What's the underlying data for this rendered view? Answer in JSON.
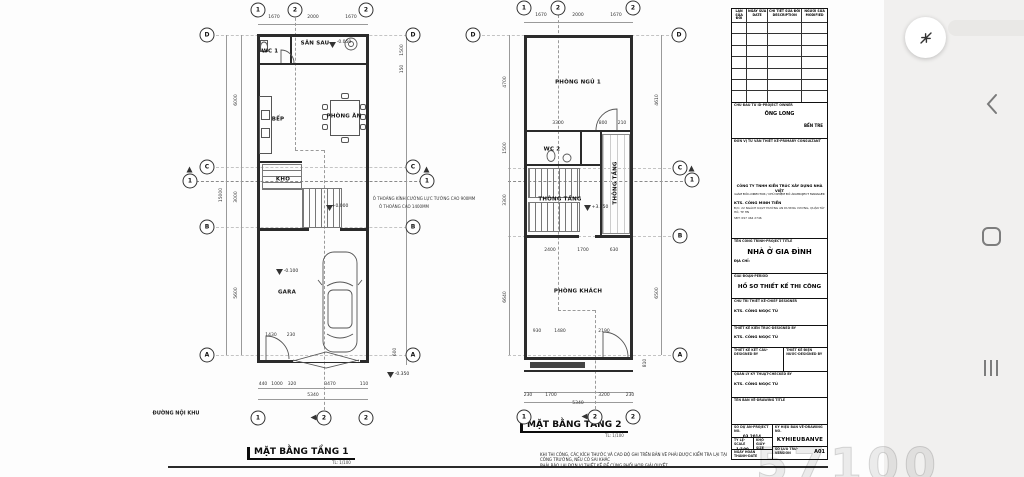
{
  "viewer": {
    "watermark": "57100",
    "icons": {
      "fab": "collapse-arrows-icon",
      "back": "back-chevron-icon",
      "home": "home-icon",
      "recents": "recents-icon"
    }
  },
  "plan1": {
    "title": "MẶT BẰNG TẦNG 1",
    "scale_note": "TL: 1/100",
    "labels": [
      {
        "t": "1670",
        "x": 274,
        "y": 18,
        "k": "dim"
      },
      {
        "t": "2000",
        "x": 313,
        "y": 18,
        "k": "dim"
      },
      {
        "t": "1670",
        "x": 351,
        "y": 18,
        "k": "dim"
      },
      {
        "t": "15000",
        "x": 222,
        "y": 195,
        "k": "dim",
        "r": 1
      },
      {
        "t": "6000",
        "x": 237,
        "y": 100,
        "k": "dim",
        "r": 1
      },
      {
        "t": "3000",
        "x": 237,
        "y": 197,
        "k": "dim",
        "r": 1
      },
      {
        "t": "5600",
        "x": 237,
        "y": 293,
        "k": "dim",
        "r": 1
      },
      {
        "t": "1500",
        "x": 403,
        "y": 50,
        "k": "dim",
        "r": 1
      },
      {
        "t": "150",
        "x": 403,
        "y": 69,
        "k": "dim",
        "r": 1
      },
      {
        "t": "600",
        "x": 396,
        "y": 352,
        "k": "dim",
        "r": 1
      },
      {
        "t": "1430",
        "x": 271,
        "y": 336,
        "k": "dim"
      },
      {
        "t": "230",
        "x": 291,
        "y": 336,
        "k": "dim"
      },
      {
        "t": "440",
        "x": 263,
        "y": 385,
        "k": "dim"
      },
      {
        "t": "1000",
        "x": 277,
        "y": 385,
        "k": "dim"
      },
      {
        "t": "320",
        "x": 292,
        "y": 385,
        "k": "dim"
      },
      {
        "t": "3470",
        "x": 330,
        "y": 385,
        "k": "dim"
      },
      {
        "t": "110",
        "x": 364,
        "y": 385,
        "k": "dim"
      },
      {
        "t": "5340",
        "x": 313,
        "y": 396,
        "k": "dim"
      },
      {
        "t": "-0.050",
        "x": 344,
        "y": 43,
        "k": "lvl"
      },
      {
        "t": "+0.000",
        "x": 340,
        "y": 207,
        "k": "lvl"
      },
      {
        "t": "-0.100",
        "x": 291,
        "y": 272,
        "k": "lvl"
      },
      {
        "t": "-0.350",
        "x": 402,
        "y": 375,
        "k": "lvl"
      },
      {
        "t": "WC 1",
        "x": 270,
        "y": 52,
        "k": "room"
      },
      {
        "t": "SÂN SAU",
        "x": 315,
        "y": 44,
        "k": "room"
      },
      {
        "t": "PHÒNG ĂN",
        "x": 344,
        "y": 117,
        "k": "room"
      },
      {
        "t": "BẾP",
        "x": 278,
        "y": 120,
        "k": "room"
      },
      {
        "t": "KHO",
        "x": 283,
        "y": 180,
        "k": "room"
      },
      {
        "t": "GARA",
        "x": 287,
        "y": 293,
        "k": "room"
      },
      {
        "t": "Ô THOÁNG KÍNH CƯỜNG LỰC TƯỜNG CAO 900MM",
        "x": 424,
        "y": 199,
        "k": "note"
      },
      {
        "t": "Ô THOÁNG CAO 1400MM",
        "x": 404,
        "y": 207,
        "k": "note"
      },
      {
        "t": "ĐƯỜNG NỘI KHU",
        "x": 176,
        "y": 414,
        "k": "street"
      }
    ],
    "bubbles": [
      {
        "l": "1",
        "x": 258,
        "y": 10
      },
      {
        "l": "2",
        "x": 295,
        "y": 10
      },
      {
        "l": "2",
        "x": 366,
        "y": 10
      },
      {
        "l": "D",
        "x": 207,
        "y": 35
      },
      {
        "l": "C",
        "x": 207,
        "y": 167
      },
      {
        "l": "B",
        "x": 207,
        "y": 227
      },
      {
        "l": "A",
        "x": 207,
        "y": 355
      },
      {
        "l": "D",
        "x": 413,
        "y": 35
      },
      {
        "l": "C",
        "x": 413,
        "y": 167
      },
      {
        "l": "B",
        "x": 413,
        "y": 227
      },
      {
        "l": "A",
        "x": 413,
        "y": 355
      },
      {
        "l": "1",
        "x": 258,
        "y": 418
      },
      {
        "l": "2",
        "x": 324,
        "y": 418,
        "a": "l"
      },
      {
        "l": "2",
        "x": 366,
        "y": 418
      },
      {
        "l": "1",
        "x": 190,
        "y": 181,
        "a": "u"
      },
      {
        "l": "1",
        "x": 427,
        "y": 181,
        "a": "u"
      }
    ]
  },
  "plan2": {
    "title": "MẶT BẰNG TẦNG 2",
    "scale_note": "TL: 1/100",
    "notes": [
      "KHI THI CÔNG, CÁC KÍCH THƯỚC VÀ CAO ĐỘ GHI TRÊN BẢN VẼ PHẢI ĐƯỢC KIỂM TRA LẠI TẠI CÔNG TRƯỜNG, NẾU CÓ SAI KHÁC",
      "PHẢI BÁO LẠI ĐƠN VỊ THIẾT KẾ ĐỂ CÙNG PHỐI HỢP GIẢI QUYẾT."
    ],
    "labels": [
      {
        "t": "1670",
        "x": 541,
        "y": 16,
        "k": "dim"
      },
      {
        "t": "2000",
        "x": 578,
        "y": 16,
        "k": "dim"
      },
      {
        "t": "1670",
        "x": 616,
        "y": 16,
        "k": "dim"
      },
      {
        "t": "4700",
        "x": 506,
        "y": 82,
        "k": "dim",
        "r": 1
      },
      {
        "t": "1500",
        "x": 506,
        "y": 148,
        "k": "dim",
        "r": 1
      },
      {
        "t": "3300",
        "x": 506,
        "y": 200,
        "k": "dim",
        "r": 1
      },
      {
        "t": "6640",
        "x": 506,
        "y": 297,
        "k": "dim",
        "r": 1
      },
      {
        "t": "4610",
        "x": 658,
        "y": 100,
        "k": "dim",
        "r": 1
      },
      {
        "t": "6500",
        "x": 658,
        "y": 293,
        "k": "dim",
        "r": 1
      },
      {
        "t": "3300",
        "x": 558,
        "y": 124,
        "k": "dim"
      },
      {
        "t": "800",
        "x": 603,
        "y": 124,
        "k": "dim"
      },
      {
        "t": "210",
        "x": 622,
        "y": 124,
        "k": "dim"
      },
      {
        "t": "2400",
        "x": 550,
        "y": 251,
        "k": "dim"
      },
      {
        "t": "1700",
        "x": 583,
        "y": 251,
        "k": "dim"
      },
      {
        "t": "630",
        "x": 614,
        "y": 251,
        "k": "dim"
      },
      {
        "t": "930",
        "x": 537,
        "y": 332,
        "k": "dim"
      },
      {
        "t": "1480",
        "x": 560,
        "y": 332,
        "k": "dim"
      },
      {
        "t": "2190",
        "x": 604,
        "y": 332,
        "k": "dim"
      },
      {
        "t": "230",
        "x": 528,
        "y": 396,
        "k": "dim"
      },
      {
        "t": "1700",
        "x": 551,
        "y": 396,
        "k": "dim"
      },
      {
        "t": "3200",
        "x": 604,
        "y": 396,
        "k": "dim"
      },
      {
        "t": "230",
        "x": 630,
        "y": 396,
        "k": "dim"
      },
      {
        "t": "5340",
        "x": 578,
        "y": 404,
        "k": "dim"
      },
      {
        "t": "810",
        "x": 646,
        "y": 363,
        "k": "dim",
        "r": 1
      },
      {
        "t": "+3.750",
        "x": 600,
        "y": 208,
        "k": "lvl"
      },
      {
        "t": "PHÒNG NGỦ 1",
        "x": 578,
        "y": 83,
        "k": "room"
      },
      {
        "t": "WC 2",
        "x": 552,
        "y": 150,
        "k": "room"
      },
      {
        "t": "THÔNG TẦNG",
        "x": 616,
        "y": 183,
        "k": "room",
        "r": 1
      },
      {
        "t": "THÔNG TẦNG",
        "x": 560,
        "y": 200,
        "k": "room"
      },
      {
        "t": "PHÒNG KHÁCH",
        "x": 578,
        "y": 292,
        "k": "room"
      }
    ],
    "bubbles": [
      {
        "l": "1",
        "x": 524,
        "y": 8
      },
      {
        "l": "2",
        "x": 558,
        "y": 8
      },
      {
        "l": "2",
        "x": 633,
        "y": 8
      },
      {
        "l": "D",
        "x": 473,
        "y": 35
      },
      {
        "l": "D",
        "x": 679,
        "y": 35
      },
      {
        "l": "C",
        "x": 680,
        "y": 168
      },
      {
        "l": "B",
        "x": 680,
        "y": 236
      },
      {
        "l": "A",
        "x": 680,
        "y": 355
      },
      {
        "l": "1",
        "x": 524,
        "y": 417
      },
      {
        "l": "2",
        "x": 595,
        "y": 417,
        "a": "l"
      },
      {
        "l": "2",
        "x": 633,
        "y": 417
      },
      {
        "l": "1",
        "x": 692,
        "y": 180,
        "a": "u"
      }
    ]
  },
  "titleblock": {
    "revision": {
      "headers": [
        "LẦN\nSỬA ĐỔI",
        "NGÀY SỬA\nDATE",
        "CHI TIẾT SỬA ĐỔI\nDESCRIPTION",
        "NGƯỜI SỬA\nMODIFIED"
      ],
      "empty_rows": 7
    },
    "owner": {
      "label": "CHỦ ĐẦU TƯ ID-PROJECT OWNER",
      "name": "ÔNG LONG",
      "location": "BẾN TRE"
    },
    "consultant": {
      "label": "ĐƠN VỊ TƯ VẤN THIẾT KẾ-PRIMARY CONSULTANT",
      "company": "CÔNG TY TNHH KIẾN TRÚC XÂY DỰNG NHÀ VIỆT",
      "roles": "GIÁM ĐỐC-DIRECTOR / CHỦ NHIỆM ĐỒ ÁN-PROJECT MANAGER",
      "architect": "KTS. CÔNG MINH TIẾN",
      "address": "Đ/C: 22 NGÁCH 64/27 ĐƯỜNG AN DƯƠNG VƯƠNG, QUẬN TÂY HỒ, TP HN",
      "phone": "SĐT: 097 464 2746"
    },
    "project": {
      "label": "TÊN CÔNG TRÌNH-PROJECT TITLE",
      "name": "NHÀ Ở GIA ĐÌNH",
      "address_label": "ĐỊA CHỈ:"
    },
    "period": {
      "label": "GIAI ĐOẠN-PERIOD",
      "name": "HỒ SƠ THIẾT KẾ THI CÔNG"
    },
    "chief": {
      "label": "CHỦ TRÌ THIẾT KẾ-CHIEF DESIGNER",
      "name": "KTS. CÔNG NGỌC TÚ"
    },
    "arch": {
      "label": "THIẾT KẾ KIẾN TRÚC-DESIGNED BY",
      "name": "KTS. CÔNG NGỌC TÚ"
    },
    "struct": {
      "label": "THIẾT KẾ KẾT CẤU-DESIGNED BY"
    },
    "mep": {
      "label": "THIẾT KẾ ĐIỆN NƯỚC-DESIGNED BY"
    },
    "qa": {
      "label": "QUẢN LÝ KỸ THUẬT-CHECKED BY",
      "name": "KTS. CÔNG NGỌC TÚ"
    },
    "drawing": {
      "label": "TÊN BẢN VẼ-DRAWING TITLE"
    },
    "meta": {
      "project_no_label": "SỐ DỰ ÁN-PROJECT NO.",
      "project_no": "03.2014",
      "drawing_no_label": "KÝ HIỆU BẢN VẼ-DRAWING NO.",
      "drawing_no": "KYHIEUBANVE",
      "scale_label": "TỶ LỆ-SCALE",
      "scale": "1/100",
      "size_label": "KHỔ GIẤY-SIZE",
      "size": "A2",
      "date_label": "NGÀY HOÀN THÀNH-DATE",
      "date": "16.03.2024",
      "version_label": "SỐ LƯU TRỮ-VERSION",
      "sheet": "A01"
    }
  }
}
